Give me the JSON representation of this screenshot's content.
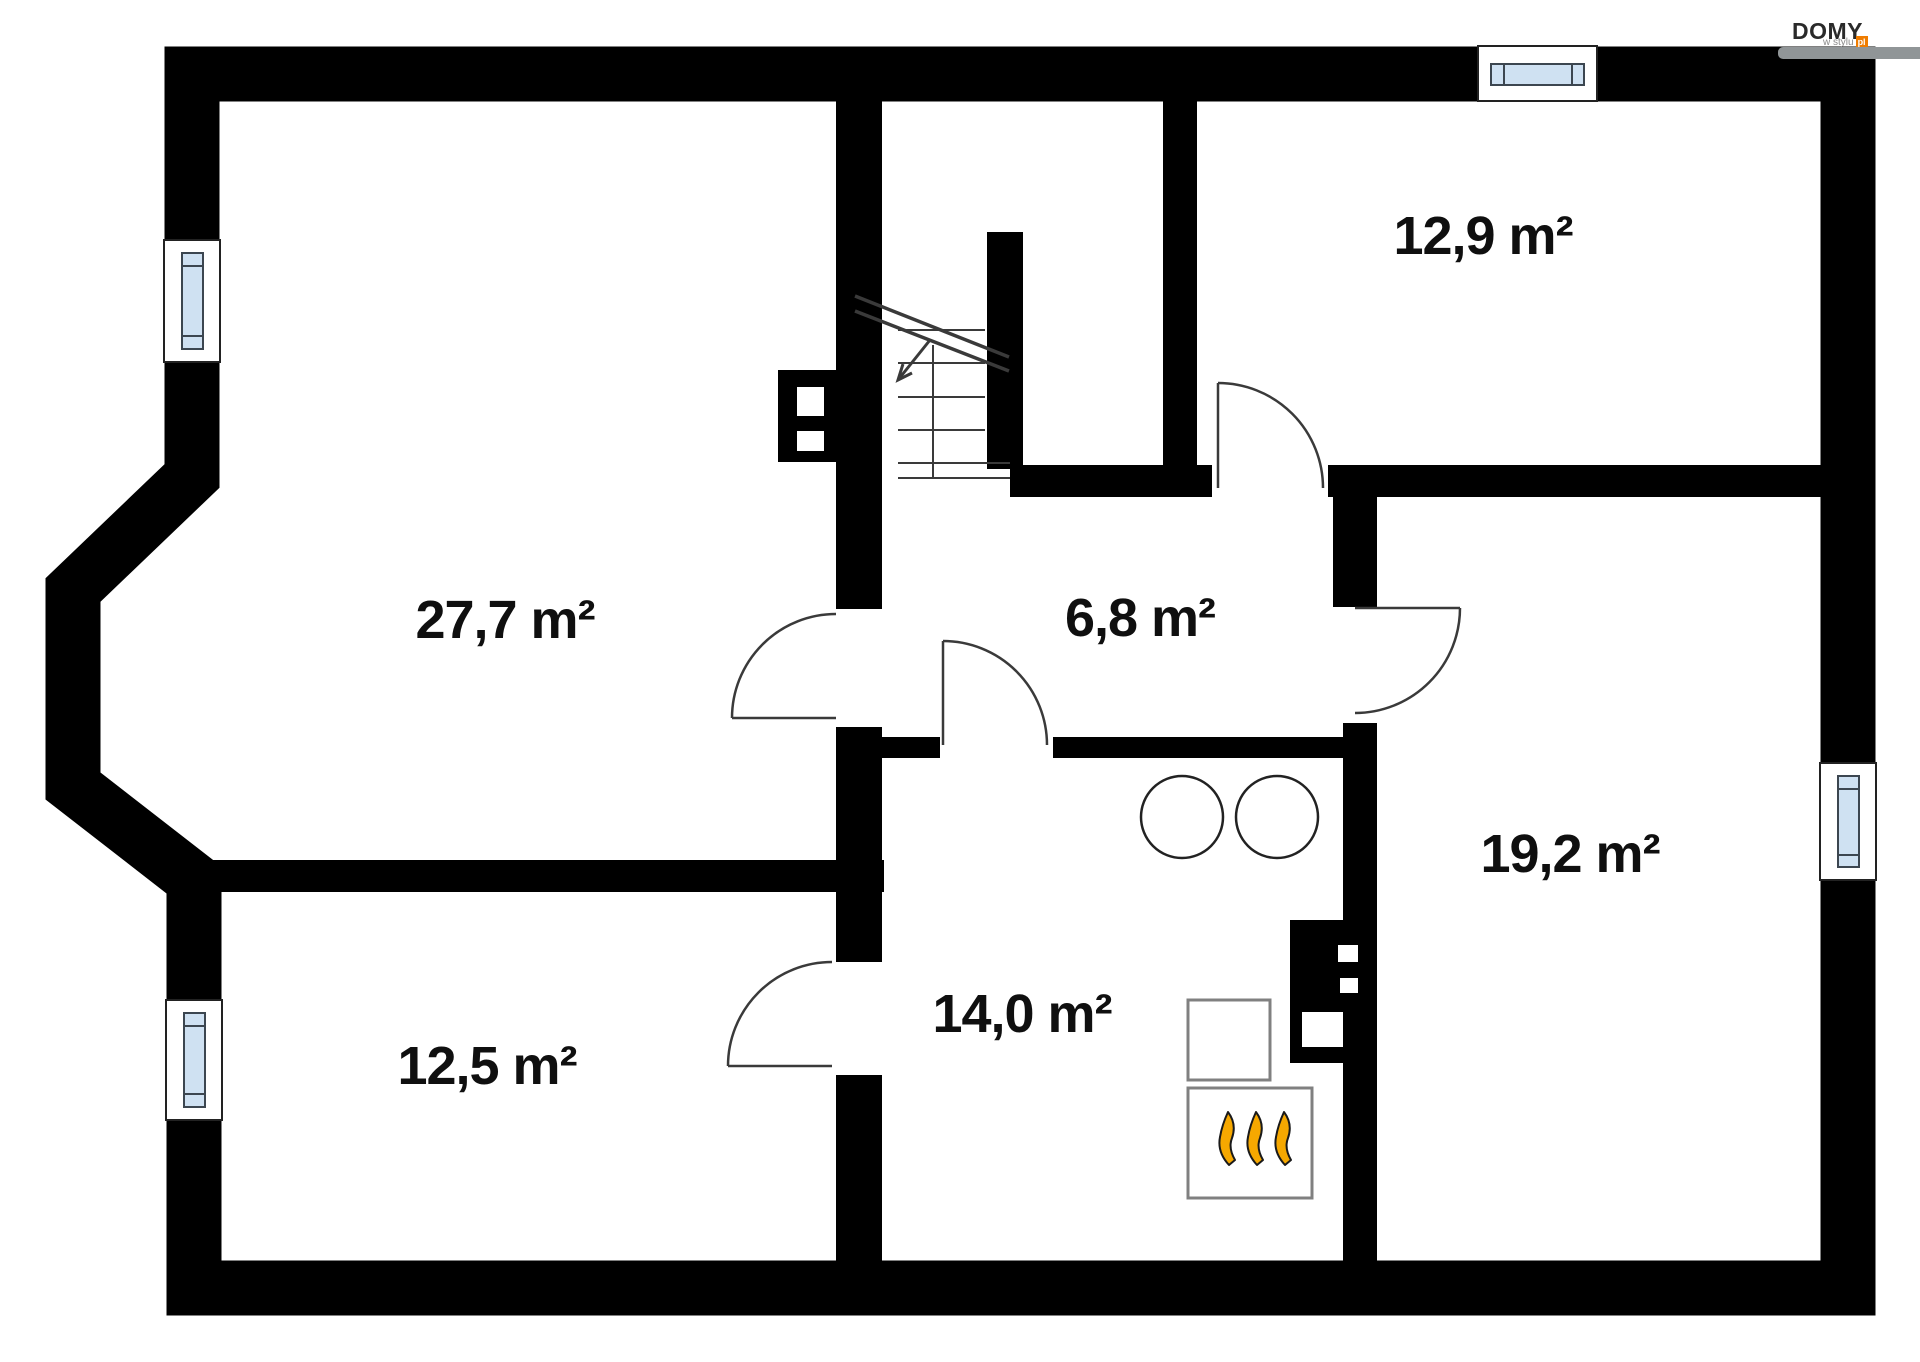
{
  "logo": {
    "brand": "DOMY",
    "tagline": "w stylu",
    "tld": "pl"
  },
  "rooms": [
    {
      "id": "room-large-left",
      "area_label": "27,7 m²"
    },
    {
      "id": "room-top-right",
      "area_label": "12,9 m²"
    },
    {
      "id": "hall-center",
      "area_label": "6,8 m²"
    },
    {
      "id": "room-right",
      "area_label": "19,2 m²"
    },
    {
      "id": "kitchen-center",
      "area_label": "14,0 m²"
    },
    {
      "id": "room-bottom-left",
      "area_label": "12,5 m²"
    }
  ],
  "colors": {
    "wall": "#000000",
    "line": "#3a3a3a",
    "window_pane": "#cfe1f2",
    "window_frame": "#3c4650",
    "fixture_border": "#808080",
    "flame": "#f6a800",
    "logo_accent": "#ef7c00",
    "logo_gray": "#909597"
  }
}
